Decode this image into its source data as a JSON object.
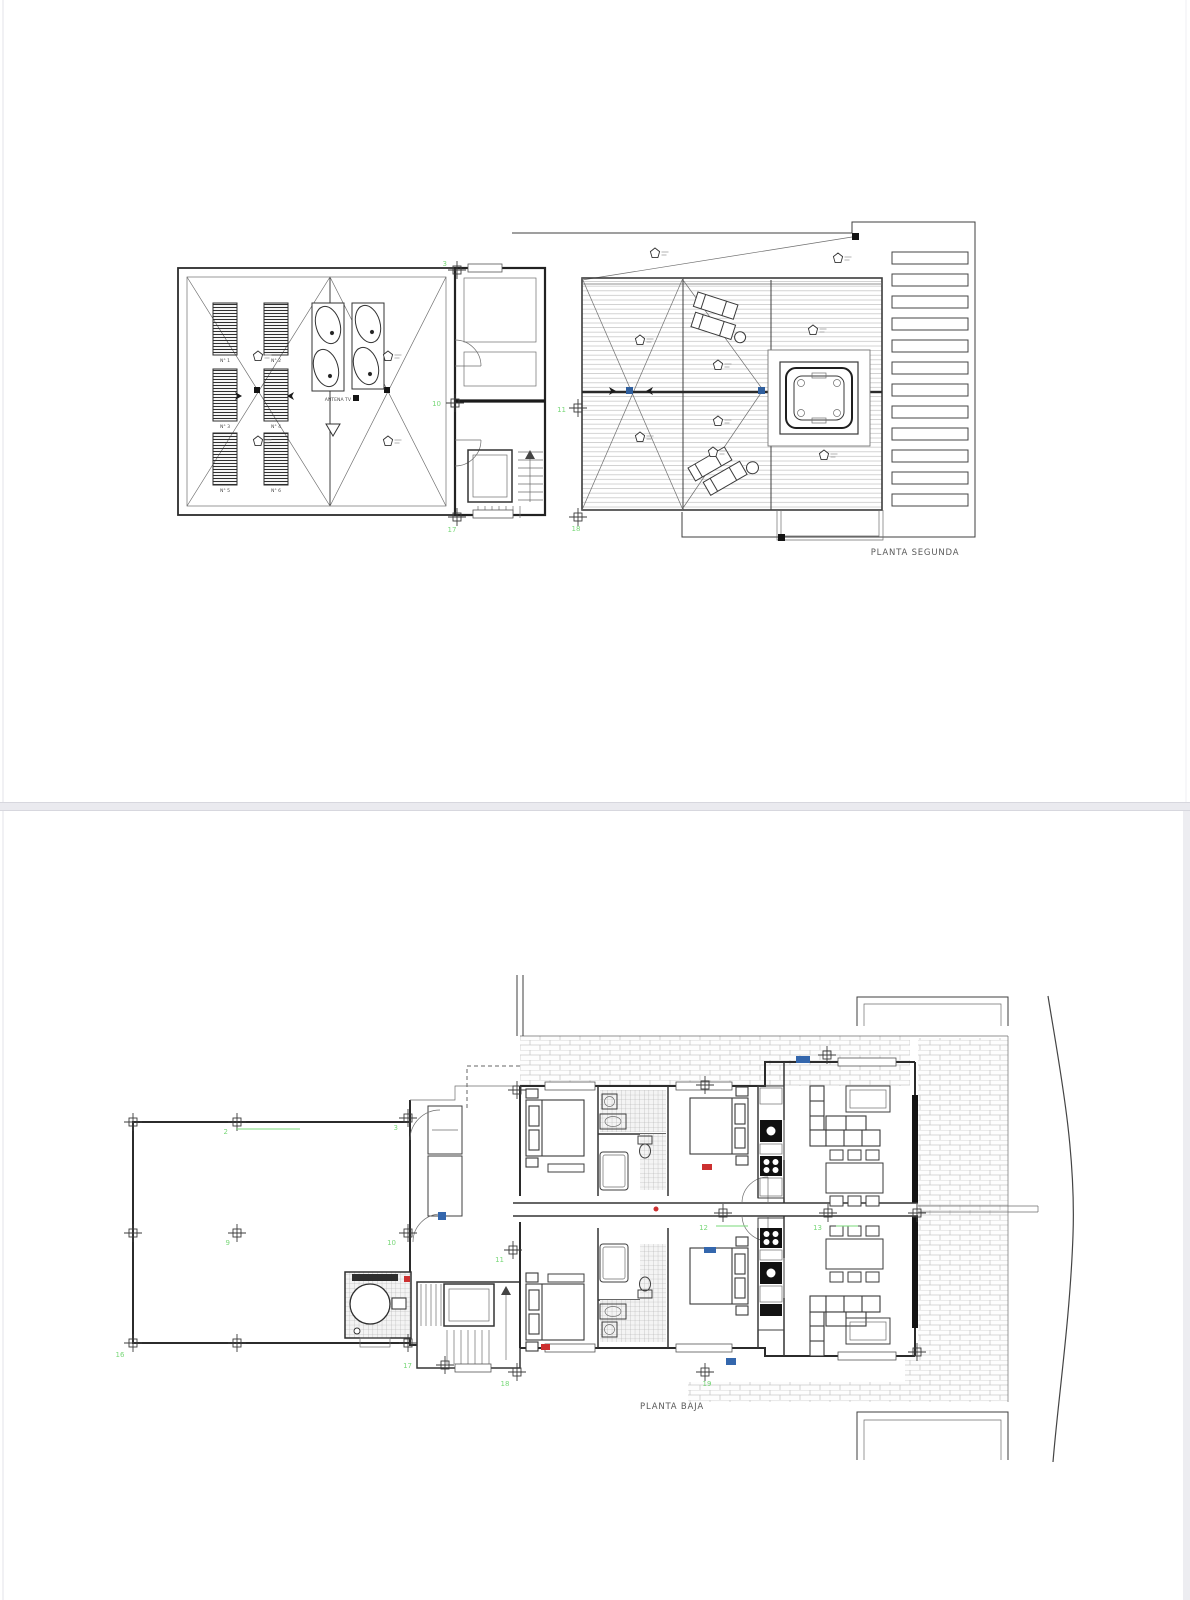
{
  "document": {
    "sheet_top": {
      "title": "PLANTA SEGUNDA",
      "antenna_label": "ANTENA TV",
      "panel_labels": [
        "N° 1",
        "N° 2",
        "N° 3",
        "N° 4",
        "N° 5",
        "N° 6"
      ],
      "column_labels": [
        "3",
        "10",
        "11",
        "17",
        "18"
      ]
    },
    "sheet_bottom": {
      "title": "PLANTA BAJA",
      "column_labels": [
        "2",
        "3",
        "9",
        "10",
        "11",
        "12",
        "13",
        "16",
        "17",
        "18",
        "19"
      ]
    },
    "colors": {
      "column_label_green": "#79d879",
      "window_marker_blue": "#3467ad",
      "door_marker_red": "#cc3030"
    }
  }
}
